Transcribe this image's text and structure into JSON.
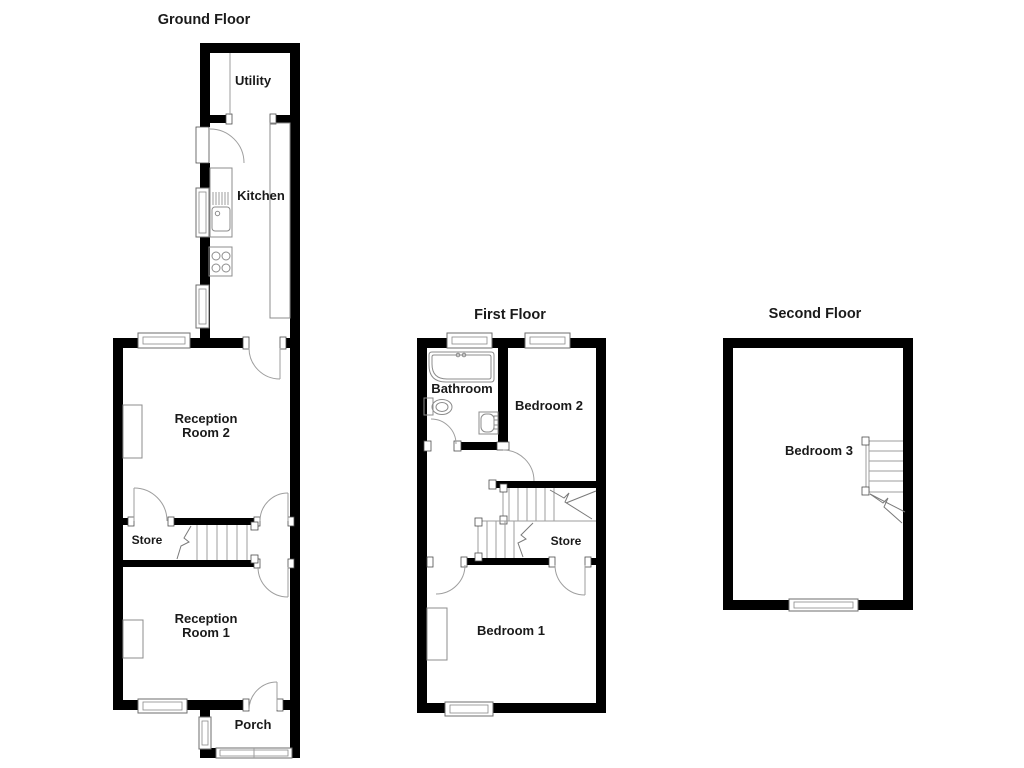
{
  "colors": {
    "wall": "#000000",
    "fixture_line": "#8c8c8c",
    "door_arc": "#9e9e9e",
    "text": "#1a1a1a",
    "background": "#ffffff"
  },
  "floors": {
    "ground": {
      "title": "Ground Floor",
      "rooms": {
        "utility": "Utility",
        "kitchen": "Kitchen",
        "reception_room_2": "Reception\nRoom 2",
        "store": "Store",
        "reception_room_1": "Reception\nRoom 1",
        "porch": "Porch"
      }
    },
    "first": {
      "title": "First Floor",
      "rooms": {
        "bathroom": "Bathroom",
        "bedroom_2": "Bedroom 2",
        "store": "Store",
        "bedroom_1": "Bedroom 1"
      }
    },
    "second": {
      "title": "Second Floor",
      "rooms": {
        "bedroom_3": "Bedroom 3"
      }
    }
  }
}
